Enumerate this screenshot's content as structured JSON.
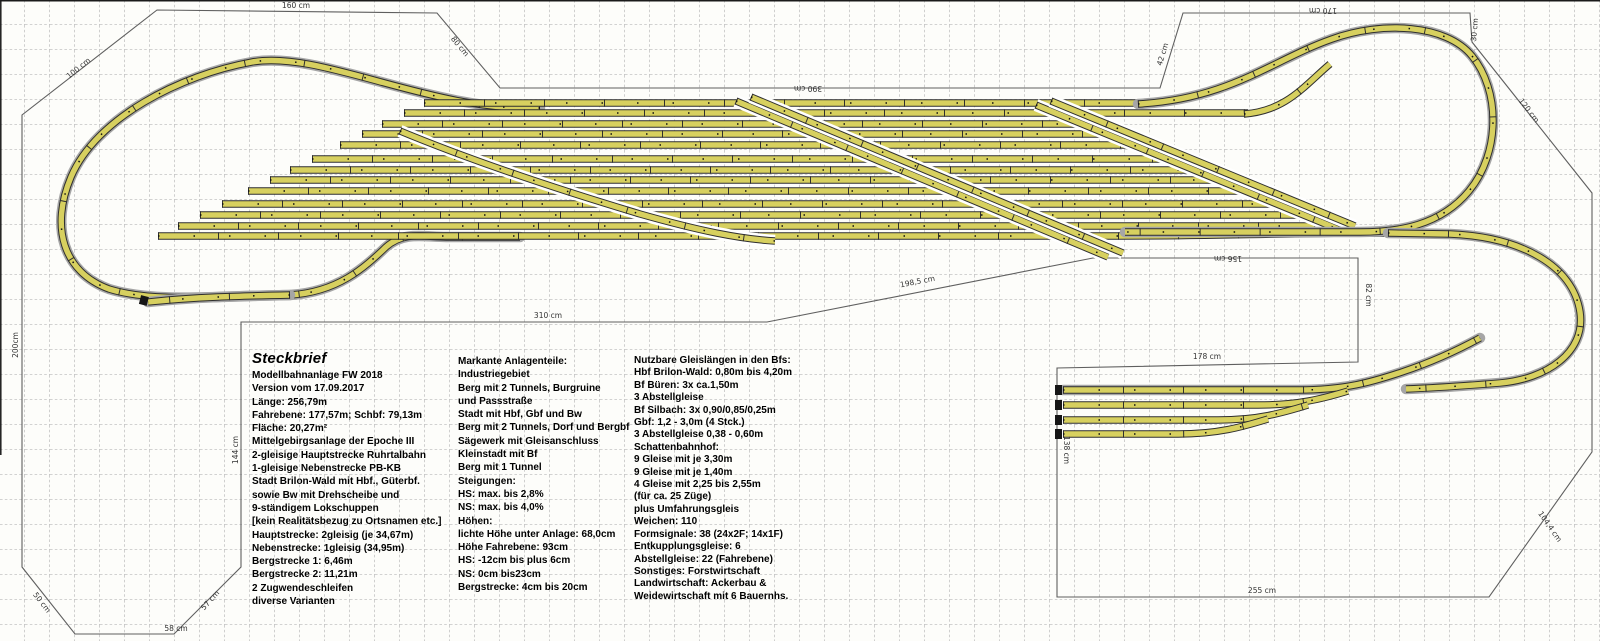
{
  "info_block": {
    "title": "Steckbrief",
    "columns": [
      {
        "lines": [
          "Modellbahnanlage FW 2018",
          "Version vom 17.09.2017",
          "Länge: 256,79m",
          "Fahrebene: 177,57m; Schbf: 79,13m",
          "Fläche: 20,27m²",
          "Mittelgebirgsanlage der Epoche III",
          "2-gleisige Hauptstrecke Ruhrtalbahn",
          "1-gleisige Nebenstrecke PB-KB",
          "Stadt Brilon-Wald mit Hbf., Güterbf.",
          "sowie Bw mit Drehscheibe und",
          "9-ständigem Lokschuppen",
          "[kein Realitätsbezug zu Ortsnamen etc.]",
          "Hauptstrecke: 2gleisig (je 34,67m)",
          "Nebenstrecke: 1gleisig (34,95m)",
          "Bergstrecke 1: 6,46m",
          "Bergstrecke 2: 11,21m",
          "2 Zugwendeschleifen",
          "diverse Varianten"
        ]
      },
      {
        "lines": [
          "Markante Anlagenteile:",
          "Industriegebiet",
          "Berg mit 2 Tunnels, Burgruine",
          "und Passstraße",
          "Stadt mit Hbf, Gbf und Bw",
          "Berg mit 2 Tunnels, Dorf und Bergbf",
          "Sägewerk mit Gleisanschluss",
          "Kleinstadt mit Bf",
          "Berg mit 1 Tunnel",
          "Steigungen:",
          "HS: max. bis 2,8%",
          "NS: max. bis 4,0%",
          "Höhen:",
          "lichte Höhe unter Anlage: 68,0cm",
          "Höhe Fahrebene: 93cm",
          "HS: -12cm bis plus 6cm",
          "NS: 0cm bis23cm",
          "Bergstrecke: 4cm bis 20cm"
        ]
      },
      {
        "lines": [
          "Nutzbare Gleislängen in den Bfs:",
          "Hbf Brilon-Wald: 0,80m bis 4,20m",
          "Bf Büren: 3x ca.1,50m",
          "3 Abstellgleise",
          "Bf Silbach: 3x 0,90/0,85/0,25m",
          "Gbf: 1,2 - 3,0m (4 Stck.)",
          "3 Abstellgleise 0,38 - 0,60m",
          "Schattenbahnhof:",
          "9 Gleise mit je 3,30m",
          "9 Gleise mit je 1,40m",
          "4 Gleise mit 2,25 bis 2,55m",
          "(für ca. 25 Züge)",
          "plus Umfahrungsgleis",
          "Weichen: 110",
          "Formsignale: 38 (24x2F; 14x1F)",
          "Entkupplungsgleise: 6",
          "Abstellgleise: 22 (Fahrebene)",
          "Sonstiges: Forstwirtschaft",
          "Landwirtschaft: Ackerbau &",
          "Weidewirtschaft mit 6 Bauernhs."
        ]
      }
    ]
  },
  "dimension_labels": [
    {
      "text": "160 cm",
      "x": 296,
      "y": 8,
      "rot": 0
    },
    {
      "text": "100 cm",
      "x": 80,
      "y": 70,
      "rot": -39
    },
    {
      "text": "80 cm",
      "x": 458,
      "y": 48,
      "rot": 50
    },
    {
      "text": "390 cm",
      "x": 808,
      "y": 86,
      "rot": 180
    },
    {
      "text": "42 cm",
      "x": 1165,
      "y": 55,
      "rot": -73
    },
    {
      "text": "170 cm",
      "x": 1323,
      "y": 8,
      "rot": 180
    },
    {
      "text": "30 cm",
      "x": 1477,
      "y": 30,
      "rot": -85
    },
    {
      "text": "120 cm",
      "x": 1527,
      "y": 112,
      "rot": 52
    },
    {
      "text": "200cm",
      "x": 18,
      "y": 345,
      "rot": -90
    },
    {
      "text": "144 cm",
      "x": 238,
      "y": 450,
      "rot": -90
    },
    {
      "text": "310 cm",
      "x": 548,
      "y": 318,
      "rot": 0
    },
    {
      "text": "198,5 cm",
      "x": 918,
      "y": 284,
      "rot": -11
    },
    {
      "text": "156 cm",
      "x": 1228,
      "y": 256,
      "rot": 180
    },
    {
      "text": "82 cm",
      "x": 1366,
      "y": 295,
      "rot": 90
    },
    {
      "text": "178 cm",
      "x": 1207,
      "y": 359,
      "rot": 0
    },
    {
      "text": "138 cm",
      "x": 1064,
      "y": 450,
      "rot": 90
    },
    {
      "text": "255 cm",
      "x": 1262,
      "y": 593,
      "rot": 0
    },
    {
      "text": "104,4 cm",
      "x": 1548,
      "y": 528,
      "rot": 55
    },
    {
      "text": "50 cm",
      "x": 40,
      "y": 604,
      "rot": 52
    },
    {
      "text": "58 cm",
      "x": 176,
      "y": 631,
      "rot": 0
    },
    {
      "text": "57 cm",
      "x": 212,
      "y": 602,
      "rot": -48
    }
  ],
  "colors": {
    "background": "#fdfdfa",
    "grid_line": "#c3c3c3",
    "boundary_line": "#5f5f5f",
    "track_fill": "#d7d05f",
    "track_edge": "#2f2f2f",
    "track_bed": "#a6a6a6",
    "text_color": "#000000",
    "dim_text": "#333333"
  }
}
